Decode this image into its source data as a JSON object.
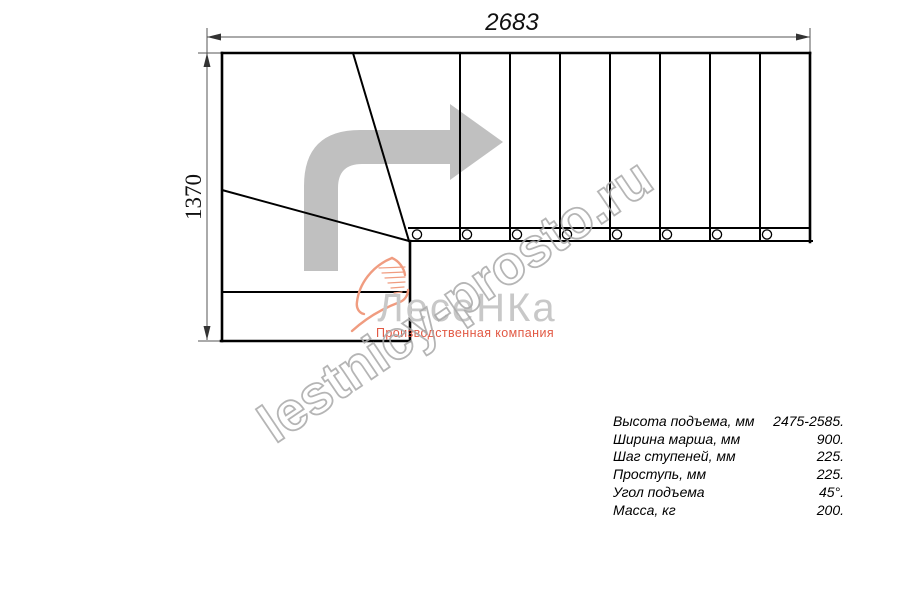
{
  "drawing": {
    "dim_length_label": "2683",
    "dim_width_label": "1370"
  },
  "watermark": {
    "text": "lestnicy-prosto.ru"
  },
  "logo": {
    "wordmark": "ЛесеНКа",
    "subtitle": "Производственная компания"
  },
  "specs": {
    "rows": [
      {
        "label": "Высота подъема, мм",
        "value": "2475-2585."
      },
      {
        "label": "Ширина марша, мм",
        "value": "900."
      },
      {
        "label": "Шаг ступеней, мм",
        "value": "225."
      },
      {
        "label": "Проступь, мм",
        "value": "225."
      },
      {
        "label": "Угол подъема",
        "value": "45°."
      },
      {
        "label": "Масса, кг",
        "value": "200."
      }
    ]
  },
  "colors": {
    "line": "#000000",
    "dim": "#555555",
    "arrow": "#c0c0c0",
    "watermark": "#a9a9a9",
    "logo_gray": "#c8c8c8",
    "logo_accent": "#e25944",
    "logo_flame": "#f09c80"
  }
}
